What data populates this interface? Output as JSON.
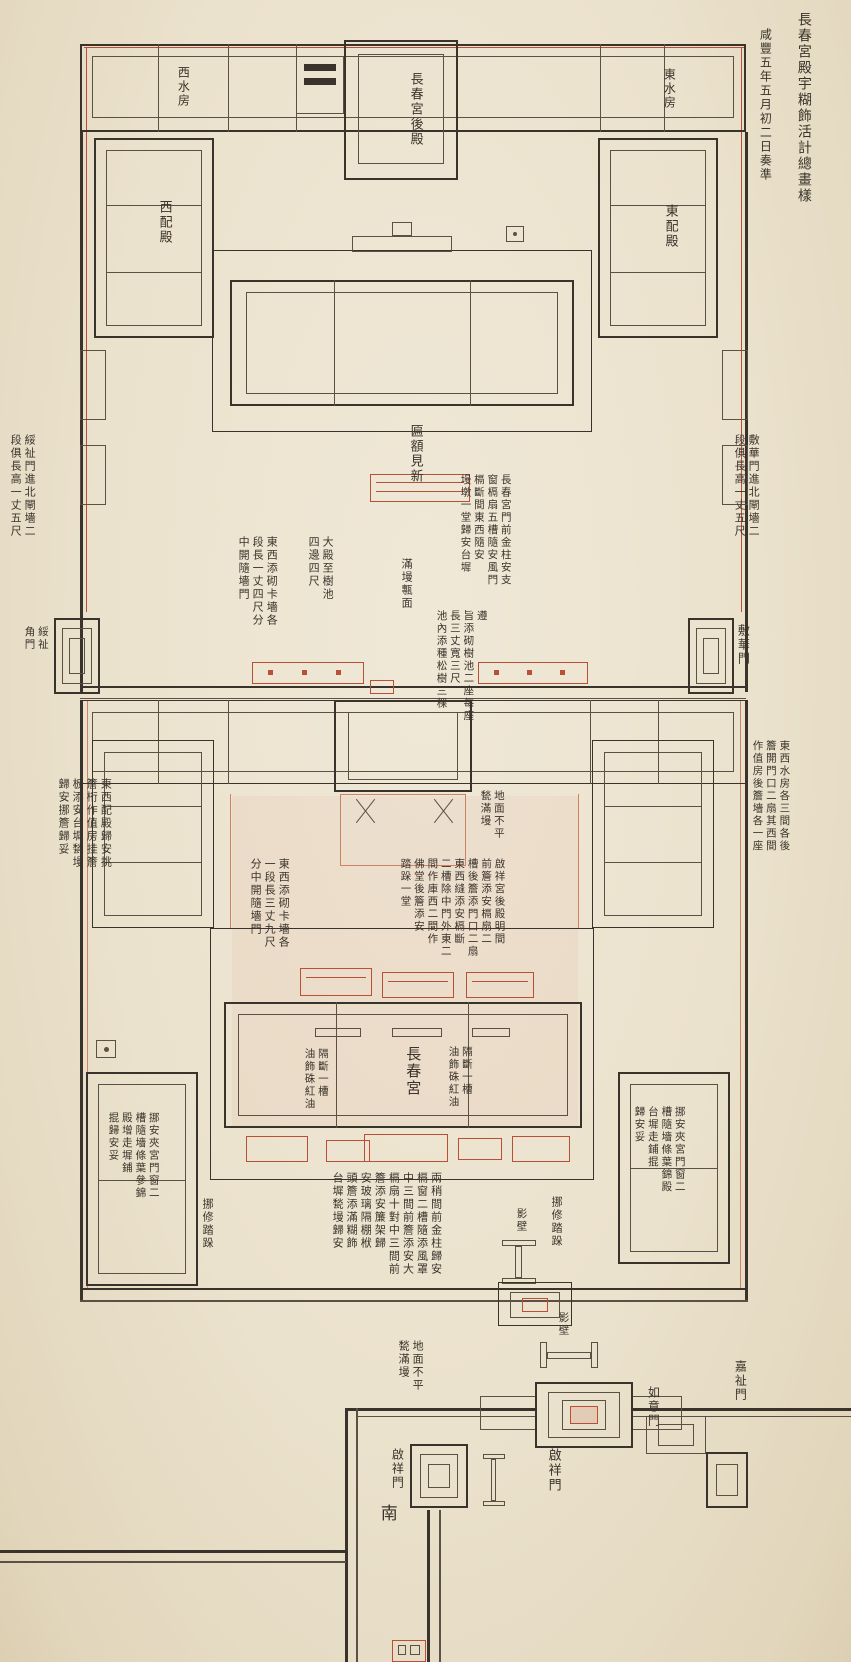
{
  "colors": {
    "paper": "#ece3d0",
    "ink": "#3a332b",
    "red": "#b94f37",
    "light_red": "#cf8166"
  },
  "labels": [
    {
      "name": "margin-title",
      "text": "長春宮殿宇糊飾活計總畫樣",
      "x": 794,
      "y": 12,
      "h": 210,
      "fs": 14
    },
    {
      "name": "margin-date",
      "text": "咸豐五年五月初二日奏準",
      "x": 757,
      "y": 28,
      "h": 170,
      "fs": 12
    },
    {
      "name": "west-water-rooms",
      "text": "西水房",
      "x": 175,
      "y": 66,
      "h": 52,
      "fs": 12
    },
    {
      "name": "east-water-rooms",
      "text": "東水房",
      "x": 661,
      "y": 68,
      "h": 52,
      "fs": 12
    },
    {
      "name": "rear-hall-label",
      "text": "長春宮後殿",
      "x": 407,
      "y": 72,
      "h": 84,
      "fs": 13
    },
    {
      "name": "west-side-hall-label",
      "text": "西配殿",
      "x": 156,
      "y": 200,
      "h": 56,
      "fs": 13
    },
    {
      "name": "east-side-hall-label",
      "text": "東配殿",
      "x": 662,
      "y": 204,
      "h": 56,
      "fs": 13
    },
    {
      "name": "plaque-renew-note",
      "text": "匾額見新",
      "x": 407,
      "y": 424,
      "h": 68,
      "fs": 13
    },
    {
      "name": "note-west-wall",
      "text": "綏祉門進北閘墻二\n段俱長高一丈五尺",
      "x": 8,
      "y": 434,
      "h": 118,
      "fs": 11
    },
    {
      "name": "note-east-wall",
      "text": "敷華門進北閘墻二\n段俱長高一丈五尺",
      "x": 732,
      "y": 434,
      "h": 118,
      "fs": 11
    },
    {
      "name": "note-upper-screen-wall",
      "text": "東西添砌卡墻各\n段長一丈四尺分\n中開隨墻門",
      "x": 236,
      "y": 536,
      "h": 102,
      "fs": 11
    },
    {
      "name": "note-hall-to-treepit",
      "text": "大殿至樹池\n四邊四尺",
      "x": 306,
      "y": 536,
      "h": 74,
      "fs": 11
    },
    {
      "name": "note-paving",
      "text": "滿墁甎面",
      "x": 399,
      "y": 558,
      "h": 60,
      "fs": 11
    },
    {
      "name": "note-front-columns",
      "text": "長春宮門前金柱安支\n窗槅扇五槽隨安風門\n槅斷間東西隨安\n墁墩一堂歸安台墀",
      "x": 458,
      "y": 474,
      "h": 120,
      "fs": 10.5
    },
    {
      "name": "note-tree-pits",
      "text": "遵\n旨添砌樹池二座每座\n長三丈寬三尺\n池內添種松樹三棵",
      "x": 434,
      "y": 610,
      "h": 118,
      "fs": 10.5
    },
    {
      "name": "west-corner-gate-label",
      "text": "綏祉\n角門",
      "x": 22,
      "y": 626,
      "h": 36,
      "fs": 10.5
    },
    {
      "name": "east-corner-gate-label",
      "text": "敷華門",
      "x": 735,
      "y": 624,
      "h": 48,
      "fs": 12
    },
    {
      "name": "note-side-halls-repair",
      "text": "東西配殿歸安挑\n簷桁作值房挂簷\n板添安台墀甃墁\n歸安挪簷歸妥",
      "x": 56,
      "y": 778,
      "h": 98,
      "fs": 11
    },
    {
      "name": "note-water-rooms-doors",
      "text": "東西水房各三間各後\n簷開門口二扇其西間\n作值房後簷墻各一座",
      "x": 750,
      "y": 740,
      "h": 118,
      "fs": 10.5
    },
    {
      "name": "note-mid-screen-wall",
      "text": "東西添砌卡墻各\n一段長三丈九尺\n分中開隨墻門",
      "x": 248,
      "y": 858,
      "h": 98,
      "fs": 11
    },
    {
      "name": "note-rear-hall-works",
      "text": "啟祥宮後殿明間\n前簷添安槅扇二\n槽後簷添門口二扇\n東西縫添安槅斷\n二槽除中門外東二\n間作庫西二間作\n佛堂後簷添安\n踏跺一堂",
      "x": 398,
      "y": 858,
      "h": 106,
      "fs": 10.5
    },
    {
      "name": "note-uneven-ground-1",
      "text": "地面不平\n甃滿墁",
      "x": 478,
      "y": 790,
      "h": 58,
      "fs": 10.5
    },
    {
      "name": "changchun-hall-label",
      "text": "長春宮",
      "x": 402,
      "y": 1046,
      "h": 60,
      "fs": 15
    },
    {
      "name": "note-partition-west",
      "text": "隔斷一槽\n油飾硃紅油",
      "x": 302,
      "y": 1048,
      "h": 70,
      "fs": 10.5
    },
    {
      "name": "note-partition-east",
      "text": "隔斷一槽\n油飾硃紅油",
      "x": 446,
      "y": 1046,
      "h": 70,
      "fs": 10.5
    },
    {
      "name": "note-steps-west",
      "text": "挪修踏跺",
      "x": 200,
      "y": 1198,
      "h": 58,
      "fs": 11
    },
    {
      "name": "note-steps-east",
      "text": "挪修踏跺",
      "x": 549,
      "y": 1196,
      "h": 58,
      "fs": 11
    },
    {
      "name": "note-sw-rooms",
      "text": "挪安夾宮門窗二\n槽隨墻條葉參錦\n殿增走墀鋪\n掍歸安妥",
      "x": 106,
      "y": 1112,
      "h": 95,
      "fs": 10.5
    },
    {
      "name": "note-se-rooms",
      "text": "挪安夾宮門窗二\n槽隨墻條葉錦殿\n台墀走鋪掍\n歸安妥",
      "x": 632,
      "y": 1106,
      "h": 95,
      "fs": 10.5
    },
    {
      "name": "note-front-facade-works",
      "text": "兩稍間前金柱歸安\n槅窗二槽隨添風罩\n中三間前簷添安大\n槅扇十對中三間前\n簷添安簾架歸\n安玻璃隔棚栿\n頭簷添滿糊飾\n台墀甃墁歸安",
      "x": 330,
      "y": 1172,
      "h": 112,
      "fs": 11
    },
    {
      "name": "screen-wall-label-1",
      "text": "影壁",
      "x": 514,
      "y": 1208,
      "h": 32,
      "fs": 10.5
    },
    {
      "name": "screen-wall-label-2",
      "text": "影壁",
      "x": 556,
      "y": 1312,
      "h": 32,
      "fs": 10.5
    },
    {
      "name": "note-uneven-ground-2",
      "text": "地面不平\n甃滿墁",
      "x": 396,
      "y": 1340,
      "h": 60,
      "fs": 11
    },
    {
      "name": "qixiang-gate-main-label",
      "text": "啟祥門",
      "x": 545,
      "y": 1448,
      "h": 52,
      "fs": 13
    },
    {
      "name": "qixiang-gate-west-label",
      "text": "啟祥門",
      "x": 389,
      "y": 1448,
      "h": 48,
      "fs": 12
    },
    {
      "name": "ruyi-gate-label",
      "text": "如意門",
      "x": 645,
      "y": 1386,
      "h": 48,
      "fs": 12
    },
    {
      "name": "jiazhi-gate-label",
      "text": "嘉祉門",
      "x": 732,
      "y": 1360,
      "h": 48,
      "fs": 12
    },
    {
      "name": "compass-south",
      "text": "南",
      "x": 376,
      "y": 1504,
      "h": 26,
      "fs": 17
    }
  ]
}
